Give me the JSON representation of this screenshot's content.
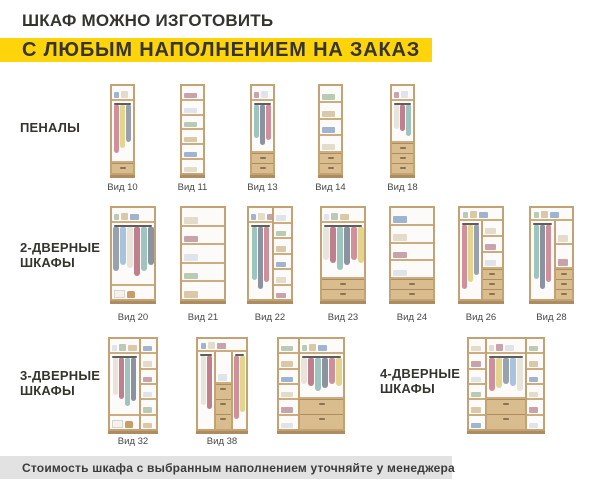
{
  "header": {
    "title": "ШКАФ МОЖНО ИЗГОТОВИТЬ",
    "subtitle": "С ЛЮБЫМ НАПОЛНЕНИЕМ НА ЗАКАЗ"
  },
  "colors": {
    "accent": "#FFD40A",
    "footer_bg": "#E2E2E2",
    "wood_frame": "#C3A274",
    "wood_line": "#CDAD7D",
    "drawer_face": "#D9BD8E",
    "interior": "#FCFBF9"
  },
  "groups": [
    {
      "id": "penaly",
      "label": "ПЕНАЛЫ"
    },
    {
      "id": "2-dvernye",
      "label": "2-ДВЕРНЫЕ\nШКАФЫ"
    },
    {
      "id": "3-dvernye",
      "label": "3-ДВЕРНЫЕ\nШКАФЫ"
    },
    {
      "id": "4-dvernye",
      "label": "4-ДВЕРНЫЕ\nШКАФЫ"
    }
  ],
  "caption_rows": {
    "1": 182,
    "2": 312,
    "3": 436
  },
  "cabinets": [
    {
      "label": "Вид 10",
      "row": 1,
      "x": 110,
      "y": 84,
      "w": 25,
      "h": 94,
      "cols": [
        {
          "f": 1,
          "zones": [
            {
              "t": "shelf"
            },
            {
              "t": "hang",
              "f": 5
            },
            {
              "t": "drawers",
              "n": 1
            }
          ]
        }
      ]
    },
    {
      "label": "Вид 11",
      "row": 1,
      "x": 180,
      "y": 84,
      "w": 25,
      "h": 94,
      "cols": [
        {
          "f": 1,
          "zones": [
            {
              "t": "shelves",
              "n": 6
            }
          ]
        }
      ]
    },
    {
      "label": "Вид 13",
      "row": 1,
      "x": 250,
      "y": 84,
      "w": 25,
      "h": 94,
      "cols": [
        {
          "f": 1,
          "zones": [
            {
              "t": "shelf"
            },
            {
              "t": "hang",
              "f": 4
            },
            {
              "t": "drawers",
              "n": 2
            }
          ]
        }
      ]
    },
    {
      "label": "Вид 14",
      "row": 1,
      "x": 318,
      "y": 84,
      "w": 25,
      "h": 94,
      "cols": [
        {
          "f": 1,
          "zones": [
            {
              "t": "shelves",
              "n": 4
            },
            {
              "t": "drawers",
              "n": 2
            }
          ]
        }
      ]
    },
    {
      "label": "Вид 18",
      "row": 1,
      "x": 390,
      "y": 84,
      "w": 25,
      "h": 94,
      "cols": [
        {
          "f": 1,
          "zones": [
            {
              "t": "shelf"
            },
            {
              "t": "hang",
              "f": 3
            },
            {
              "t": "drawers",
              "n": 3
            }
          ]
        }
      ]
    },
    {
      "label": "Вид 20",
      "row": 2,
      "x": 110,
      "y": 206,
      "w": 46,
      "h": 98,
      "cols": [
        {
          "f": 1,
          "zones": [
            {
              "t": "shelf"
            },
            {
              "t": "hang",
              "f": 5
            },
            {
              "t": "open"
            }
          ]
        }
      ]
    },
    {
      "label": "Вид 21",
      "row": 2,
      "x": 180,
      "y": 206,
      "w": 46,
      "h": 98,
      "cols": [
        {
          "f": 1,
          "zones": [
            {
              "t": "shelves",
              "n": 5
            }
          ]
        }
      ]
    },
    {
      "label": "Вид 22",
      "row": 2,
      "x": 247,
      "y": 206,
      "w": 46,
      "h": 98,
      "cols": [
        {
          "f": 1.3,
          "zones": [
            {
              "t": "shelf"
            },
            {
              "t": "hang",
              "f": 1
            }
          ]
        },
        {
          "f": 1,
          "zones": [
            {
              "t": "shelves",
              "n": 6
            }
          ]
        }
      ]
    },
    {
      "label": "Вид 23",
      "row": 2,
      "x": 320,
      "y": 206,
      "w": 46,
      "h": 98,
      "cols": [
        {
          "f": 1,
          "zones": [
            {
              "t": "shelf"
            },
            {
              "t": "hang",
              "f": 4
            },
            {
              "t": "drawers",
              "n": 2
            }
          ]
        }
      ]
    },
    {
      "label": "Вид 24",
      "row": 2,
      "x": 389,
      "y": 206,
      "w": 46,
      "h": 98,
      "cols": [
        {
          "f": 1,
          "zones": [
            {
              "t": "shelves",
              "n": 4
            },
            {
              "t": "drawers",
              "n": 2
            }
          ]
        }
      ]
    },
    {
      "label": "Вид 26",
      "row": 2,
      "x": 458,
      "y": 206,
      "w": 46,
      "h": 98,
      "topShelf": true,
      "cols": [
        {
          "f": 1.1,
          "zones": [
            {
              "t": "hang",
              "f": 1
            }
          ]
        },
        {
          "f": 1,
          "zones": [
            {
              "t": "shelves",
              "n": 3
            },
            {
              "t": "drawers",
              "n": 3
            }
          ]
        }
      ]
    },
    {
      "label": "Вид 28",
      "row": 2,
      "x": 529,
      "y": 206,
      "w": 45,
      "h": 98,
      "topShelf": true,
      "cols": [
        {
          "f": 1.5,
          "zones": [
            {
              "t": "hang",
              "f": 1
            }
          ]
        },
        {
          "f": 1,
          "zones": [
            {
              "t": "shelves",
              "n": 2
            },
            {
              "t": "drawers",
              "n": 3
            }
          ]
        }
      ]
    },
    {
      "label": "Вид 32",
      "row": 3,
      "x": 108,
      "y": 337,
      "w": 50,
      "h": 97,
      "cols": [
        {
          "f": 1.9,
          "zones": [
            {
              "t": "shelf"
            },
            {
              "t": "hang",
              "f": 4
            },
            {
              "t": "open"
            }
          ]
        },
        {
          "f": 1,
          "zones": [
            {
              "t": "shelves",
              "n": 6
            }
          ]
        }
      ]
    },
    {
      "label": "Вид 38",
      "row": 3,
      "x": 196,
      "y": 337,
      "w": 52,
      "h": 97,
      "topShelf": true,
      "cols": [
        {
          "f": 1.1,
          "zones": [
            {
              "t": "hang",
              "f": 1
            }
          ]
        },
        {
          "f": 1,
          "zones": [
            {
              "t": "shelves",
              "n": 1
            },
            {
              "t": "drawers",
              "n": 3,
              "big": true
            }
          ]
        },
        {
          "f": 0.9,
          "zones": [
            {
              "t": "hang",
              "f": 1
            }
          ]
        }
      ]
    },
    {
      "label": "",
      "row": 3,
      "x": 277,
      "y": 337,
      "w": 68,
      "h": 97,
      "cols": [
        {
          "f": 1,
          "zones": [
            {
              "t": "shelves",
              "n": 6
            }
          ]
        },
        {
          "f": 2.2,
          "zones": [
            {
              "t": "shelf"
            },
            {
              "t": "hang",
              "f": 1
            },
            {
              "t": "drawers",
              "n": 2,
              "big": true
            }
          ]
        }
      ]
    },
    {
      "label": "",
      "row": 3,
      "x": 467,
      "y": 337,
      "w": 78,
      "h": 97,
      "cols": [
        {
          "f": 1,
          "zones": [
            {
              "t": "shelves",
              "n": 6
            }
          ]
        },
        {
          "f": 2.3,
          "zones": [
            {
              "t": "shelf"
            },
            {
              "t": "hang",
              "f": 1
            },
            {
              "t": "drawers",
              "n": 2,
              "big": true
            }
          ]
        },
        {
          "f": 1,
          "zones": [
            {
              "t": "shelves",
              "n": 6
            }
          ]
        }
      ]
    }
  ],
  "footer": {
    "note": "Стоимость шкафа с выбранным наполнением уточняйте у менеджера"
  }
}
